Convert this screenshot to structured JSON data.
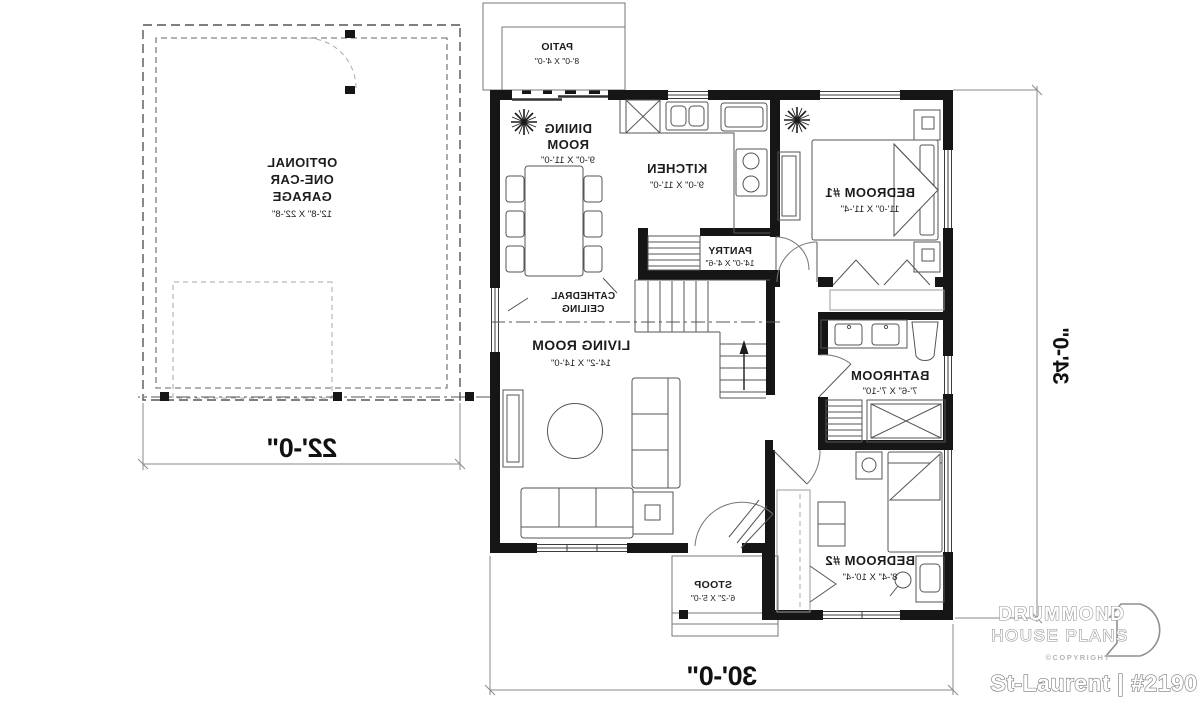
{
  "plan": {
    "rooms": [
      {
        "id": "patio",
        "name": "PATIO",
        "dims": "8'-0\" X 4'-0\""
      },
      {
        "id": "dining",
        "name": "DINING ROOM",
        "line1": "DINING",
        "line2": "ROOM",
        "dims": "9'-0\" X 11'-0\""
      },
      {
        "id": "kitchen",
        "name": "KITCHEN",
        "dims": "9'-0\" X 11'-0\""
      },
      {
        "id": "bedroom1",
        "name": "BEDROOM #1",
        "dims": "11'-0\" X 11'-4\""
      },
      {
        "id": "pantry",
        "name": "PANTRY",
        "dims": "14'-0\" X 4'-6\""
      },
      {
        "id": "living",
        "name": "LIVING ROOM",
        "dims": "14'-2\" X 14'-0\""
      },
      {
        "id": "bathroom",
        "name": "BATHROOM",
        "dims": "7'-6\" X 7'-10\""
      },
      {
        "id": "bedroom2",
        "name": "BEDROOM #2",
        "dims": "8'-4\" X 10'-4\""
      },
      {
        "id": "stoop",
        "name": "STOOP",
        "dims": "6'-2\" X 5'-0\""
      },
      {
        "id": "garage",
        "name": "OPTIONAL ONE-CAR GARAGE",
        "line1": "OPTIONAL",
        "line2": "ONE-CAR",
        "line3": "GARAGE",
        "dims": "12'-8\" X 22'-8\""
      }
    ],
    "notes": {
      "cathedral_line1": "CATHEDRAL",
      "cathedral_line2": "CEILING"
    },
    "dimensions": {
      "garage_width": "22'-0\"",
      "house_width": "30'-0\"",
      "house_depth": "34'-0\""
    },
    "orientation": "mirrored"
  },
  "title_block": {
    "brand_line1": "DRUMMOND",
    "brand_line2": "HOUSE PLANS",
    "copyright": "©COPYRIGHT",
    "plan_name": "St-Laurent | #2190"
  },
  "colors": {
    "ink": "#161616",
    "detail_line": "#555555",
    "dimension_line": "#8a8a8a",
    "logo_gray": "#8f8f8f",
    "background": "#ffffff"
  }
}
